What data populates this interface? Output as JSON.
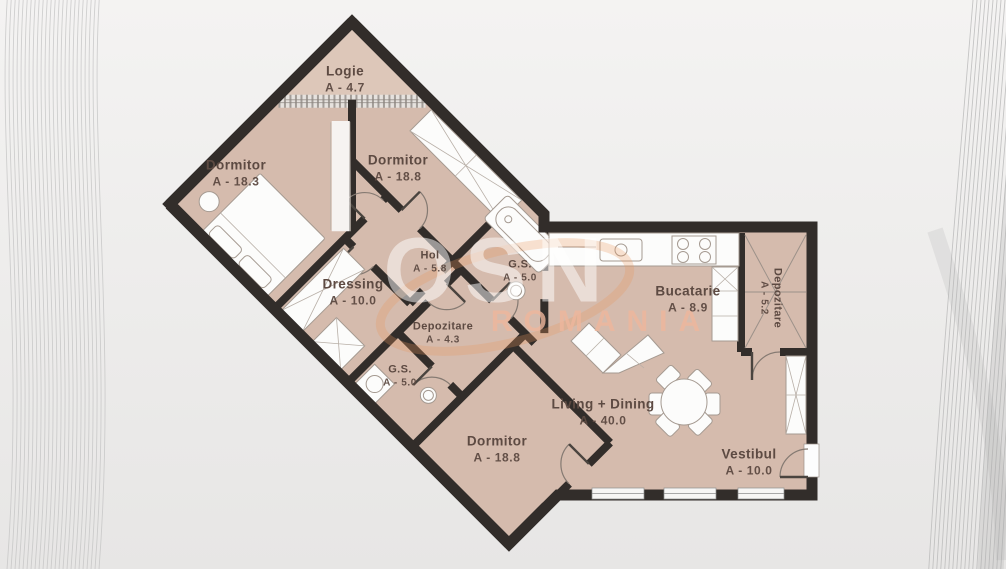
{
  "watermark": {
    "logo": "OSN",
    "subtitle": "ROMANIA"
  },
  "palette": {
    "floor": "#d5bbad",
    "balcony_floor": "#ddc7b9",
    "wall": "#322d2a",
    "label_text": "#5d4a42",
    "watermark_accent": "#e8965f",
    "watermark_text": "#efb79c",
    "furniture_fill": "#fcfcfb",
    "furniture_stroke": "#a59a91"
  },
  "rooms": [
    {
      "id": "logie",
      "name": "Logie",
      "area": "A - 4.7"
    },
    {
      "id": "dormitor-1",
      "name": "Dormitor",
      "area": "A - 18.3"
    },
    {
      "id": "dormitor-2",
      "name": "Dormitor",
      "area": "A - 18.8"
    },
    {
      "id": "hol",
      "name": "Hol",
      "area": "A - 5.8"
    },
    {
      "id": "gs-1",
      "name": "G.S.",
      "area": "A - 5.0"
    },
    {
      "id": "dressing",
      "name": "Dressing",
      "area": "A - 10.0"
    },
    {
      "id": "depozitare-1",
      "name": "Depozitare",
      "area": "A - 4.3"
    },
    {
      "id": "gs-2",
      "name": "G.S.",
      "area": "A - 5.0"
    },
    {
      "id": "dormitor-3",
      "name": "Dormitor",
      "area": "A - 18.8"
    },
    {
      "id": "bucatarie",
      "name": "Bucatarie",
      "area": "A - 8.9"
    },
    {
      "id": "depozitare-2",
      "name": "Depozitare",
      "area": "A - 5.2"
    },
    {
      "id": "living",
      "name": "Living + Dining",
      "area": "A - 40.0"
    },
    {
      "id": "vestibul",
      "name": "Vestibul",
      "area": "A - 10.0"
    }
  ]
}
